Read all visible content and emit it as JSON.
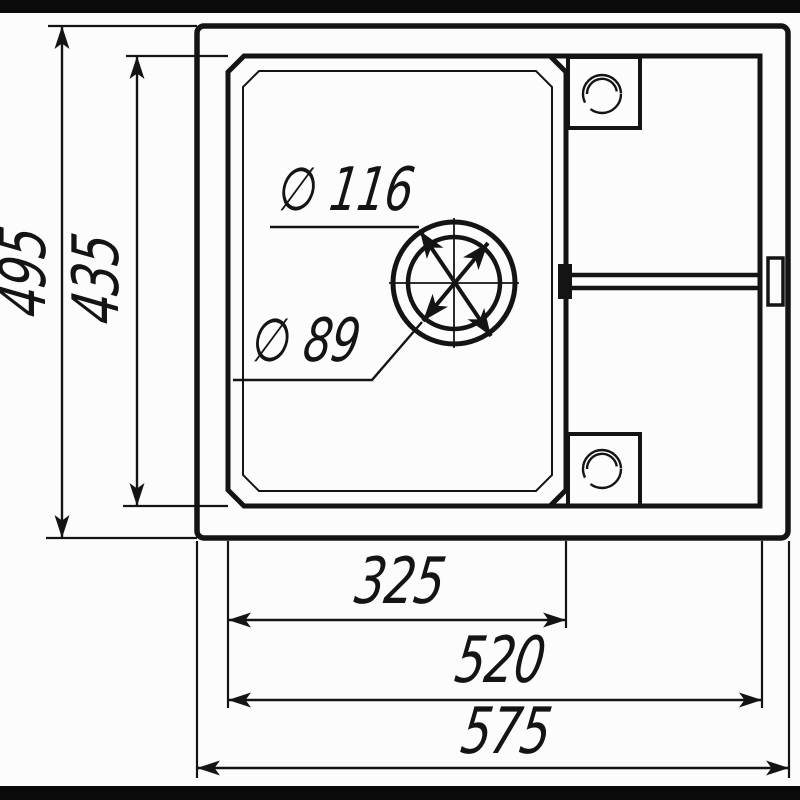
{
  "drawing": {
    "kind": "sink-top-view-dimension-drawing",
    "ink_color": "#141414",
    "paper_color": "#fcfcfc",
    "border_bar_color": "#0a0a0a"
  },
  "labels": {
    "overall_height": "495",
    "inner_height": "435",
    "drain_flange_diameter": "∅ 116",
    "drain_hole_diameter": "∅ 89",
    "bowl_width": "325",
    "inner_width": "520",
    "overall_width": "575"
  }
}
